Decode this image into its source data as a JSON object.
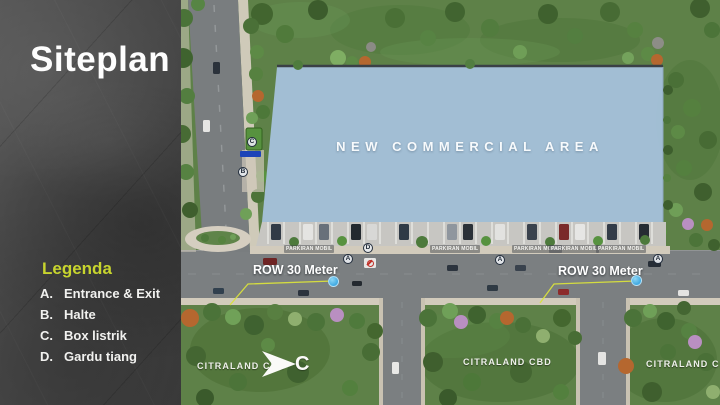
{
  "slide": {
    "title": "Siteplan",
    "legend": {
      "heading": "Legenda",
      "items": [
        {
          "key": "A.",
          "label": "Entrance & Exit"
        },
        {
          "key": "B.",
          "label": "Halte"
        },
        {
          "key": "C.",
          "label": "Box listrik"
        },
        {
          "key": "D.",
          "label": "Gardu tiang"
        }
      ]
    },
    "accent_color": "#c7d42e"
  },
  "map": {
    "area_label": "NEW COMMERCIAL AREA",
    "row_labels": [
      "ROW 30 Meter",
      "ROW 30 Meter"
    ],
    "district_labels": [
      "CITRALAND CBD",
      "CITRALAND CBD",
      "CITRALAND CBD"
    ],
    "parking_labels": [
      "PARKIRAN MOBIL",
      "PARKIRAN MOBIL",
      "PARKIRAN MOBIL",
      "PARKIRAN MOBIL",
      "PARKIRAN MOBIL"
    ],
    "markers": [
      {
        "letter": "C"
      },
      {
        "letter": "B"
      },
      {
        "letter": "A"
      },
      {
        "letter": "D"
      },
      {
        "letter": "A"
      },
      {
        "letter": "A"
      }
    ],
    "logo_letter": "C",
    "colors": {
      "parcel_blue": "#a4c1da",
      "callout_line": "#d9e23c",
      "measure_dot": "#45b6ea",
      "legend_accent": "#c7d42e"
    }
  }
}
